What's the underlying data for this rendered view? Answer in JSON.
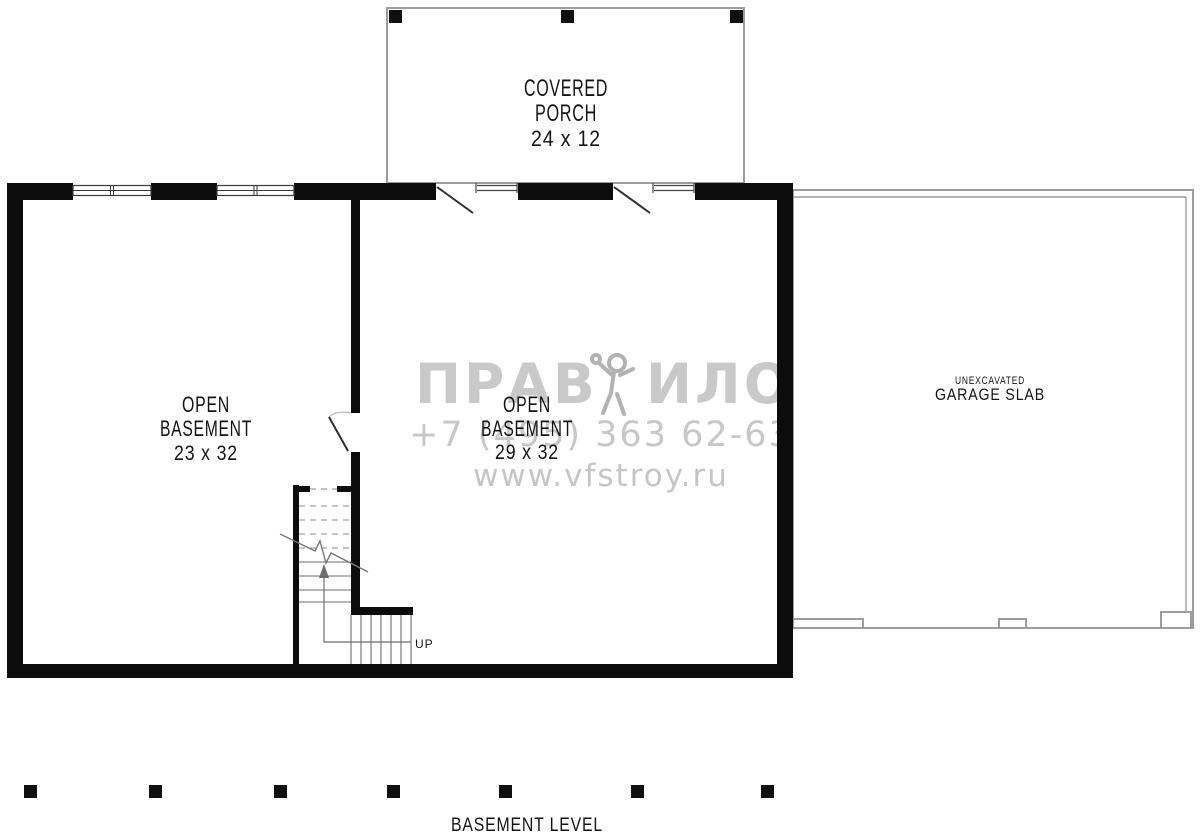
{
  "plan": {
    "porch": {
      "line1": "COVERED",
      "line2": "PORCH",
      "size": "24 x 12"
    },
    "basement_left": {
      "line1": "OPEN",
      "line2": "BASEMENT",
      "size": "23 x 32"
    },
    "basement_center": {
      "line1": "OPEN",
      "line2": "BASEMENT",
      "size": "29 x 32"
    },
    "garage": {
      "line1": "UNEXCAVATED",
      "line2": "GARAGE SLAB"
    },
    "stairs": {
      "up": "UP"
    },
    "footer": {
      "level": "BASEMENT LEVEL"
    }
  },
  "watermark": {
    "brand_left": "ПРАВ",
    "brand_right": "ИЛО",
    "phone": "+7 (495) 363 62-63",
    "website": "www.vfstroy.ru"
  },
  "colors": {
    "wall": "#0c0c0c",
    "thin_outline": "#9c9c9c",
    "watermark_text": "#c9c9c9",
    "watermark_phone": "#c7c7c7",
    "watermark_site": "#c5c5c5",
    "watermark_figure": "#b2b2b2",
    "label_text": "#141414"
  }
}
